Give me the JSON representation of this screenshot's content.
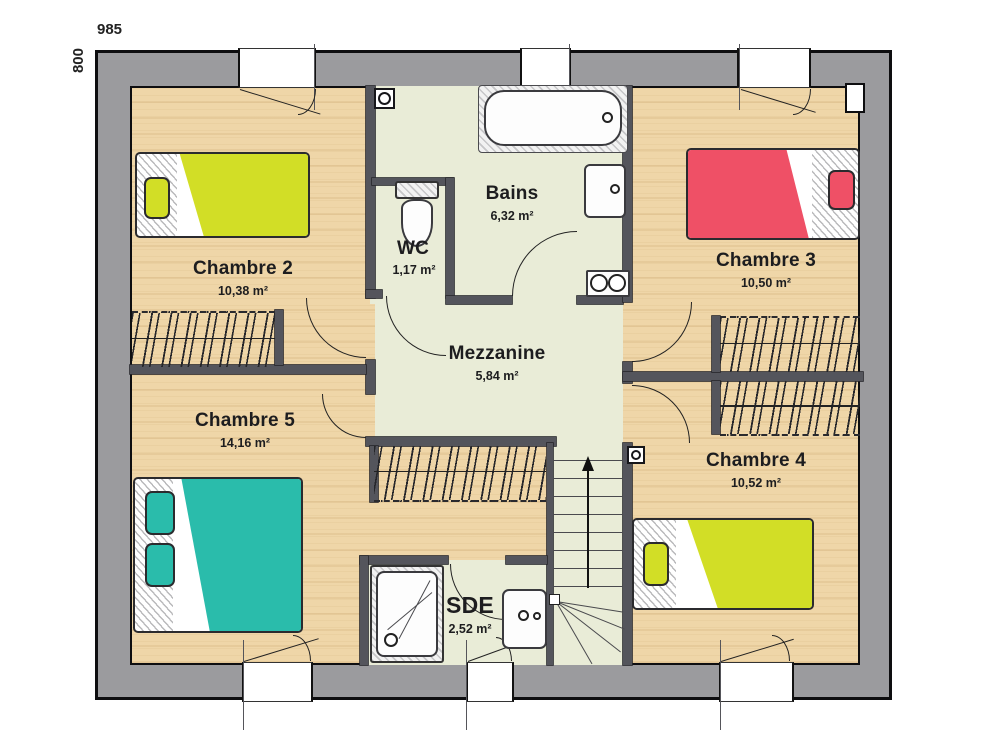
{
  "dimensions": {
    "width": "985",
    "height": "800"
  },
  "rooms": {
    "chambre2": {
      "name": "Chambre 2",
      "area": "10,38 m²"
    },
    "chambre3": {
      "name": "Chambre 3",
      "area": "10,50 m²"
    },
    "chambre4": {
      "name": "Chambre 4",
      "area": "10,52 m²"
    },
    "chambre5": {
      "name": "Chambre 5",
      "area": "14,16 m²"
    },
    "bains": {
      "name": "Bains",
      "area": "6,32 m²"
    },
    "wc": {
      "name": "WC",
      "area": "1,17 m²"
    },
    "mezzanine": {
      "name": "Mezzanine",
      "area": "5,84 m²"
    },
    "sde": {
      "name": "SDE",
      "area": "2,52 m²"
    }
  },
  "fixtures": {
    "beds": [
      "bed-chambre2-yellow",
      "bed-chambre3-red",
      "bed-chambre4-yellow",
      "bed-chambre5-teal"
    ],
    "sanitary": [
      "bathtub",
      "washbasin-bains",
      "washbasin-sde",
      "toilet",
      "shower-tray",
      "appliance-double-circle"
    ],
    "circulation": [
      "staircase-up",
      "wardrobe-chambre2",
      "wardrobe-chambre3",
      "wardrobe-chambre4",
      "wardrobe-chambre5"
    ]
  },
  "colors": {
    "exterior_wall": "#9b9b9e",
    "interior_wall": "#54555c",
    "wood_floor": "#efd6a8",
    "tile_floor": "#e9ecd7",
    "bed_yellow": "#d2de26",
    "bed_red": "#ef5066",
    "bed_teal": "#2abcab"
  }
}
